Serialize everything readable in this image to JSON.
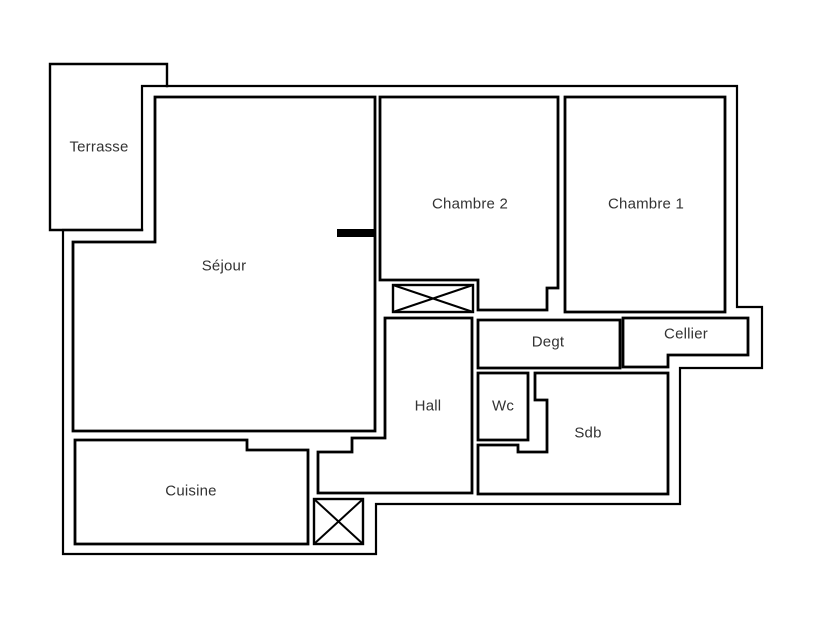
{
  "plan": {
    "type": "apartment-floor-plan",
    "background_color": "#ffffff",
    "wall_color": "#000000",
    "label_color": "#333333",
    "rooms": [
      {
        "id": "terrasse",
        "label": "Terrasse"
      },
      {
        "id": "sejour",
        "label": "Séjour"
      },
      {
        "id": "chambre2",
        "label": "Chambre 2"
      },
      {
        "id": "chambre1",
        "label": "Chambre 1"
      },
      {
        "id": "degt",
        "label": "Degt"
      },
      {
        "id": "cellier",
        "label": "Cellier"
      },
      {
        "id": "hall",
        "label": "Hall"
      },
      {
        "id": "wc",
        "label": "Wc"
      },
      {
        "id": "sdb",
        "label": "Sdb"
      },
      {
        "id": "cuisine",
        "label": "Cuisine"
      }
    ],
    "features": [
      {
        "id": "shaft-upper",
        "type": "crossed-box",
        "description": "crossed rectangle between Chambre 2 and Hall"
      },
      {
        "id": "shaft-lower",
        "type": "crossed-box",
        "description": "crossed rectangle below Hall near Cuisine"
      },
      {
        "id": "opening-marker",
        "type": "solid-bar",
        "description": "thick black bar on wall between Séjour and Chambre 2"
      }
    ]
  }
}
